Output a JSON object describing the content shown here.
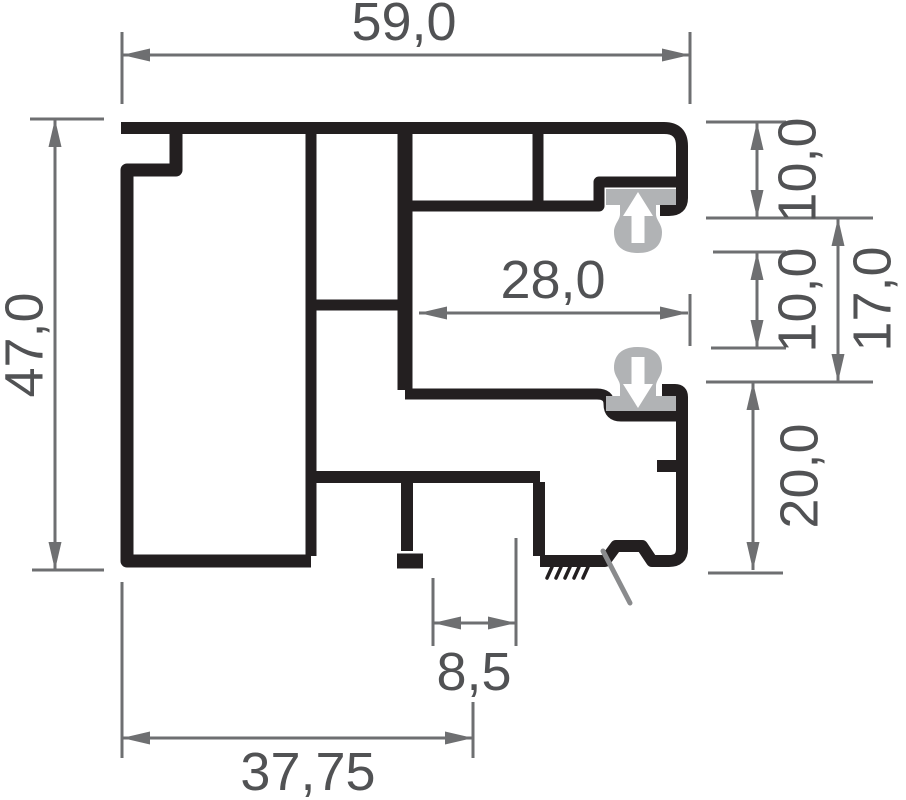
{
  "drawing": {
    "title": "aluminium-profile-cross-section",
    "units_hint": "mm (decimal comma notation)",
    "colors": {
      "profile": "#231f20",
      "gasket": "#b1b3b5",
      "dimension_line": "#6e6f71",
      "dimension_text": "#515254",
      "background": "#ffffff",
      "break_mark": "#8a8b8d"
    },
    "dimensions": [
      {
        "id": "width-top",
        "label": "59,0",
        "orientation": "horizontal",
        "value": 59.0
      },
      {
        "id": "height-left",
        "label": "47,0",
        "orientation": "vertical",
        "value": 47.0
      },
      {
        "id": "slot-width-inner",
        "label": "28,0",
        "orientation": "horizontal",
        "value": 28.0
      },
      {
        "id": "offset-top-right",
        "label": "10,0",
        "orientation": "vertical",
        "value": 10.0
      },
      {
        "id": "gap-middle-right",
        "label": "10,0",
        "orientation": "vertical",
        "value": 10.0
      },
      {
        "id": "slot-height-right",
        "label": "17,0",
        "orientation": "vertical",
        "value": 17.0
      },
      {
        "id": "height-bottom-right",
        "label": "20,0",
        "orientation": "vertical",
        "value": 20.0
      },
      {
        "id": "groove-width-bottom",
        "label": "8,5",
        "orientation": "horizontal",
        "value": 8.5
      },
      {
        "id": "width-bottom",
        "label": "37,75",
        "orientation": "horizontal",
        "value": 37.75
      }
    ]
  }
}
